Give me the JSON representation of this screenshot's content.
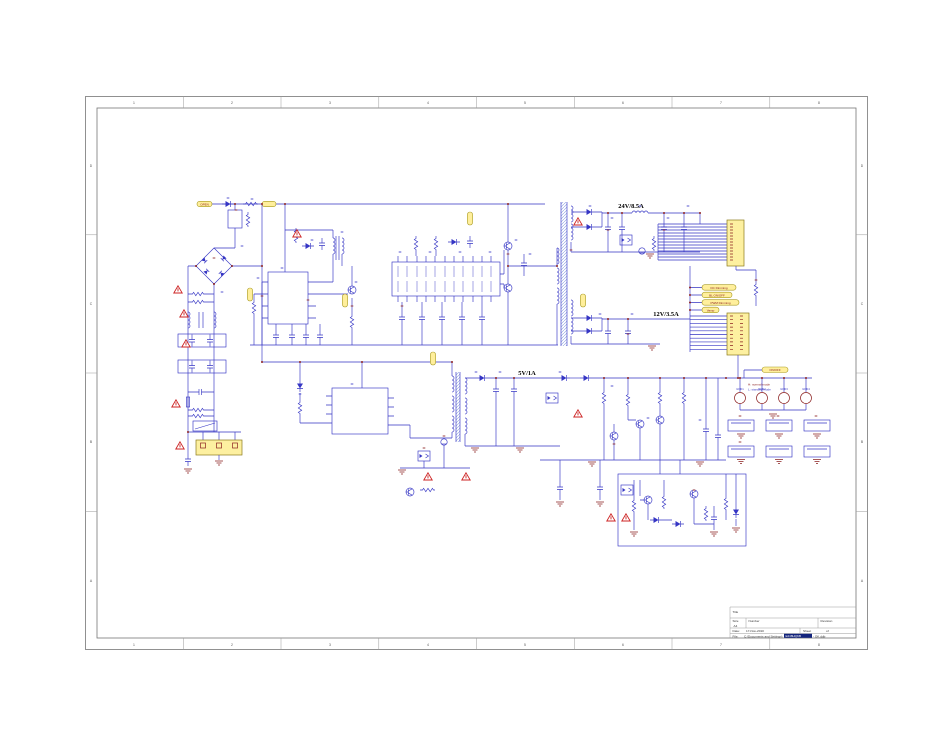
{
  "page": {
    "background": "#ffffff"
  },
  "colors": {
    "wire_blue": "#3535c4",
    "pin_maroon": "#8b2020",
    "warn_red": "#cc2222",
    "label_yellow": "#ffef9c",
    "highlight_navy": "#13247d"
  },
  "frame": {
    "columns": [
      "1",
      "2",
      "3",
      "4",
      "5",
      "6",
      "7",
      "8"
    ],
    "rows": [
      "D",
      "C",
      "B",
      "A"
    ]
  },
  "labels": {
    "rail_24v": "24V/8.5A",
    "rail_12v": "12V/3.5A",
    "rail_5v": "5V/1A",
    "open": "OPEN",
    "dc_dimming": "DC Dimming",
    "bl_onoff": "BL ON/OFF",
    "pwm_dimming": "PWM Dimming",
    "vamp": "Vamp",
    "ps_onoff": "ON/OFF",
    "mode_high": "H: normal mode",
    "mode_low": "L: standby mode",
    "gnd_pads": [
      "GND1",
      "GND2",
      "GND3",
      "GND4"
    ]
  },
  "title_block": {
    "title_label": "Title",
    "size_label": "Size",
    "size_value": "A4",
    "number_label": "Number",
    "revision_label": "Revision",
    "date_label": "Date:",
    "date_value": "17-Nov-2010",
    "sheet_label": "Sheet",
    "of_label": "of",
    "file_label": "File:",
    "file_path": "C:\\Documents and Settings\\",
    "file_highlight": "E248HQKB",
    "file_suffix": " - OK.ddb"
  }
}
